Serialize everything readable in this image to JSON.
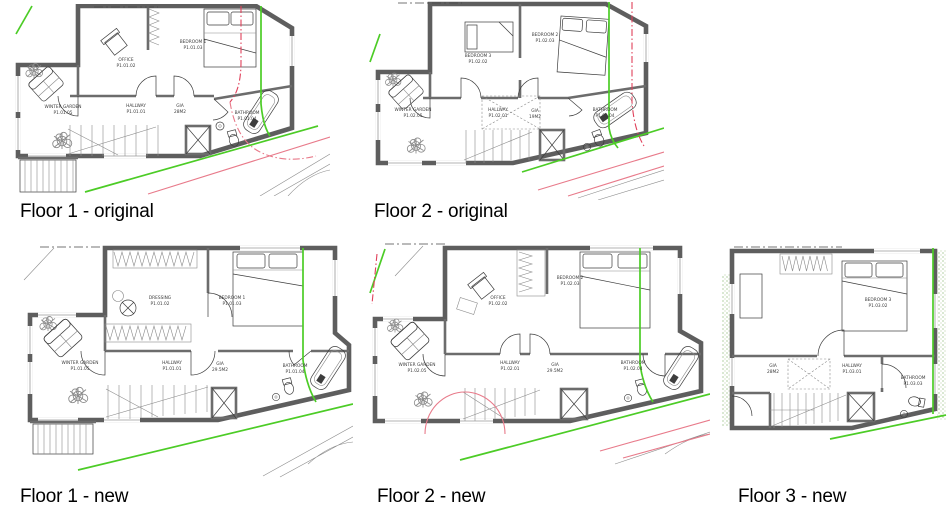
{
  "sheet": {
    "background": "#ffffff"
  },
  "colors": {
    "wall": "#5e5e5e",
    "boundary_green": "#4ccc26",
    "boundary_pink": "#e87a8a",
    "boundary_red": "#e0405a",
    "label_text": "#3c3c3c"
  },
  "plans": [
    {
      "caption": "Floor 1 - original",
      "rooms": {
        "office": {
          "name": "OFFICE",
          "code": "P1.01.02"
        },
        "bedroom": {
          "name": "BEDROOM 1",
          "code": "P1.01.03"
        },
        "winter_garden": {
          "name": "WINTER GARDEN",
          "code": "P1.01.05"
        },
        "hallway": {
          "name": "HALLWAY",
          "code": "P1.01.01"
        },
        "gia": {
          "name": "GIA",
          "code": "28M2"
        },
        "bathroom": {
          "name": "BATHROOM",
          "code": "P1.01.04"
        }
      }
    },
    {
      "caption": "Floor 2 - original",
      "rooms": {
        "bedroom3": {
          "name": "BEDROOM 3",
          "code": "P1.02.02"
        },
        "bedroom2": {
          "name": "BEDROOM 2",
          "code": "P1.02.03"
        },
        "winter_garden": {
          "name": "WINTER GARDEN",
          "code": "P1.02.05"
        },
        "hallway": {
          "name": "HALLWAY",
          "code": "P1.02.01"
        },
        "gia": {
          "name": "GIA",
          "code": "19M2"
        },
        "bathroom": {
          "name": "BATHROOM",
          "code": "P1.02.04"
        }
      }
    },
    {
      "caption": "Floor 1 - new",
      "rooms": {
        "dressing": {
          "name": "DRESSING",
          "code": "P1.01.02"
        },
        "bedroom": {
          "name": "BEDROOM 1",
          "code": "P1.01.03"
        },
        "winter_garden": {
          "name": "WINTER GARDEN",
          "code": "P1.01.05"
        },
        "hallway": {
          "name": "HALLWAY",
          "code": "P1.01.01"
        },
        "gia": {
          "name": "GIA",
          "code": "29.5M2"
        },
        "bathroom": {
          "name": "BATHROOM",
          "code": "P1.01.04"
        }
      }
    },
    {
      "caption": "Floor 2 - new",
      "rooms": {
        "office": {
          "name": "OFFICE",
          "code": "P1.02.02"
        },
        "bedroom2": {
          "name": "BEDROOM 2",
          "code": "P1.02.03"
        },
        "winter_garden": {
          "name": "WINTER GARDEN",
          "code": "P1.02.05"
        },
        "hallway": {
          "name": "HALLWAY",
          "code": "P1.02.01"
        },
        "gia": {
          "name": "GIA",
          "code": "29.5M2"
        },
        "bathroom": {
          "name": "BATHROOM",
          "code": "P1.02.04"
        }
      }
    },
    {
      "caption": "Floor 3 - new",
      "rooms": {
        "bedroom3": {
          "name": "BEDROOM 3",
          "code": "P1.03.02"
        },
        "hallway": {
          "name": "HALLWAY",
          "code": "P1.03.01"
        },
        "gia": {
          "name": "GIA",
          "code": "28M2"
        },
        "bathroom": {
          "name": "BATHROOM",
          "code": "P1.03.03"
        }
      }
    }
  ]
}
